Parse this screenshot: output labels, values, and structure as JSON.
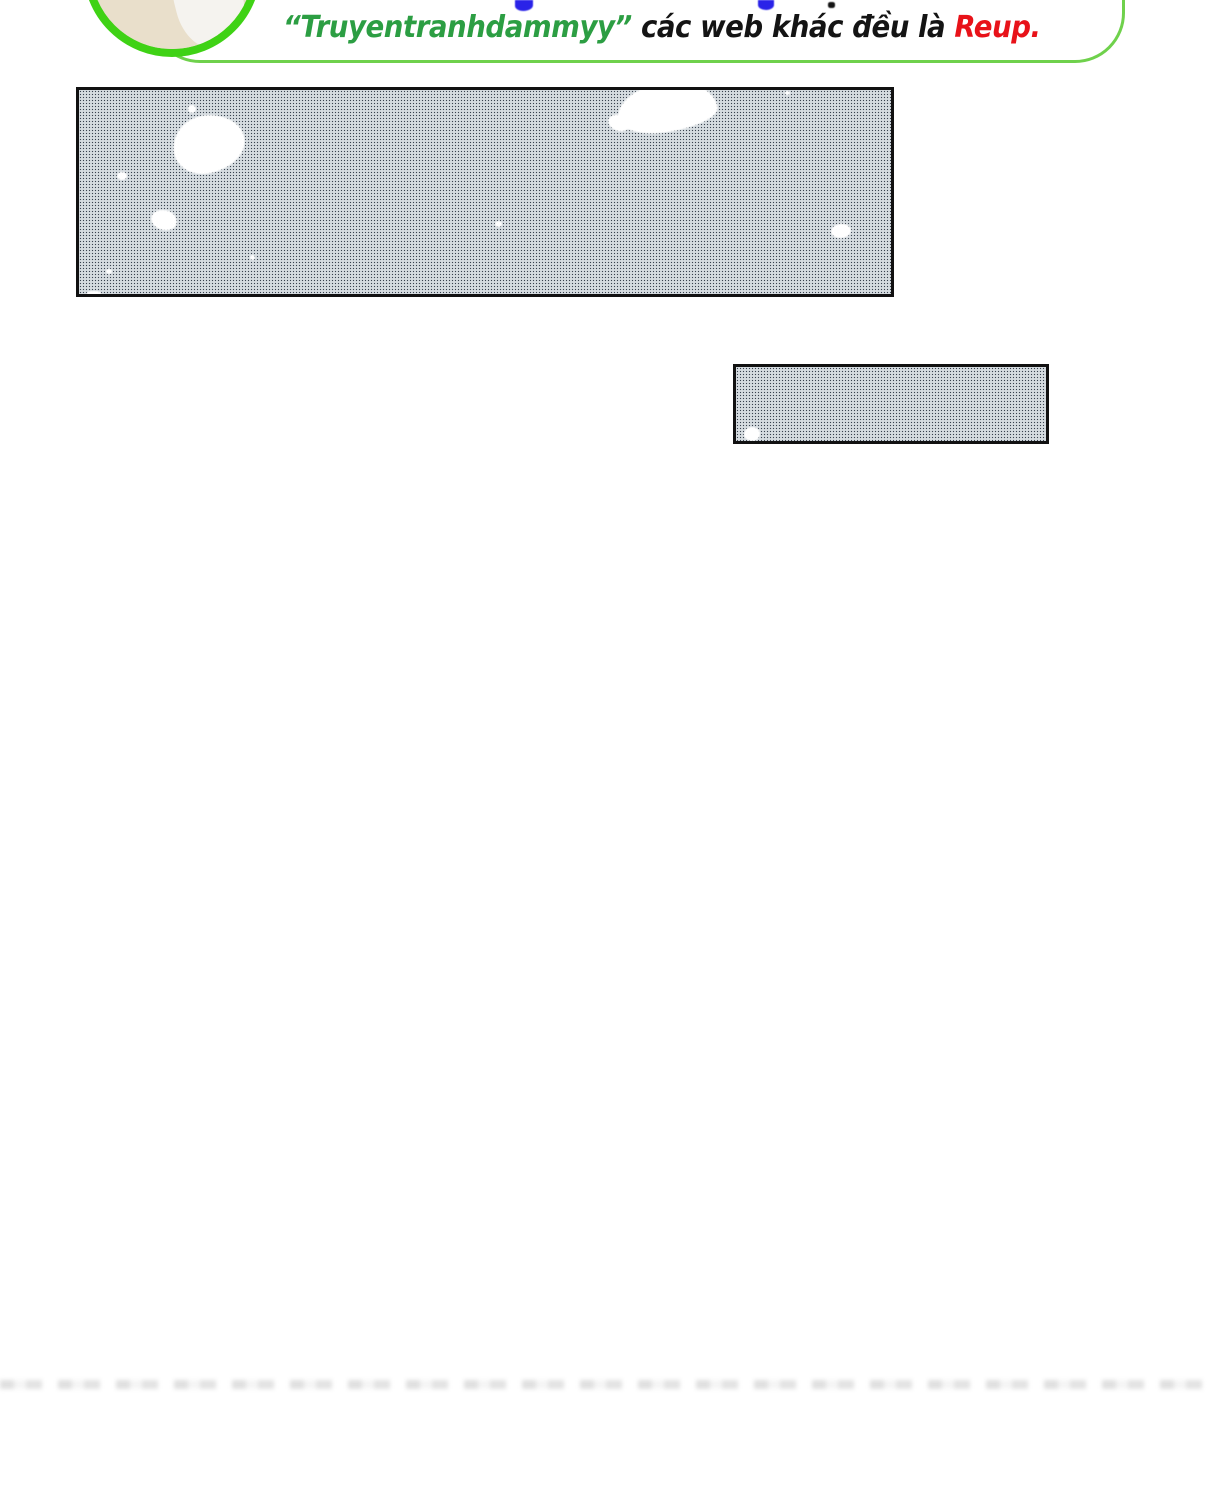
{
  "page": {
    "width": 1207,
    "height": 1500,
    "background": "#ffffff"
  },
  "banner": {
    "type": "translator-credit-banner",
    "message": {
      "quoted": "“Truyentranhdammyy”",
      "middle": " các web khác đều là ",
      "emphasis": "Reup."
    },
    "cutoff_top_line_fragments": [
      {
        "x": 515,
        "y": 0,
        "w": 18,
        "h": 11,
        "color": "#2a23e8",
        "radius": "0 0 70% 60%"
      },
      {
        "x": 758,
        "y": 0,
        "w": 16,
        "h": 10,
        "color": "#2a23e8",
        "radius": "0 0 55% 55%"
      },
      {
        "x": 828,
        "y": 2,
        "w": 7,
        "h": 6,
        "color": "#141414",
        "radius": "35%"
      }
    ],
    "colors": {
      "border_green": "#6fd14c",
      "avatar_ring_green": "#3fd215",
      "quoted_green": "#2c9e43",
      "text_black": "#141414",
      "emphasis_red": "#e81219",
      "fragment_blue": "#2a23e8"
    }
  },
  "screentone": {
    "dark": "#39424e",
    "light": "#f2f5f7",
    "base": "#ccd3d8",
    "panel_border": "#111111",
    "spot_color": "#ffffff"
  },
  "panels": [
    {
      "name": "screentone-panel-large",
      "x": 76,
      "y": 87,
      "w": 818,
      "h": 210,
      "blobs": [
        {
          "cx": 130,
          "cy": 54,
          "rx": 36,
          "ry": 29,
          "radius": "46% 54% 58% 42% / 55% 50% 50% 45%",
          "rot": -10
        },
        {
          "cx": 113,
          "cy": 19,
          "rx": 4,
          "ry": 4
        },
        {
          "cx": 43,
          "cy": 86,
          "rx": 5,
          "ry": 4
        },
        {
          "cx": 85,
          "cy": 130,
          "rx": 13,
          "ry": 10,
          "radius": "55% 45% 50% 50% / 50% 55% 45% 50%",
          "rot": 15
        },
        {
          "cx": 173,
          "cy": 167,
          "rx": 2.5,
          "ry": 2.5
        },
        {
          "cx": 30,
          "cy": 181,
          "rx": 3,
          "ry": 2.5
        },
        {
          "cx": 15,
          "cy": 203,
          "rx": 7,
          "ry": 2.5,
          "radius": "40%"
        },
        {
          "cx": 588,
          "cy": 17,
          "rx": 50,
          "ry": 25,
          "radius": "52% 48% 55% 45% / 60% 65% 35% 40%",
          "rot": -8
        },
        {
          "cx": 540,
          "cy": 33,
          "rx": 11,
          "ry": 8,
          "rot": 20
        },
        {
          "cx": 708,
          "cy": 3,
          "rx": 2.5,
          "ry": 2
        },
        {
          "cx": 419,
          "cy": 134,
          "rx": 3.5,
          "ry": 3
        },
        {
          "cx": 762,
          "cy": 141,
          "rx": 10,
          "ry": 7,
          "rot": -5
        }
      ]
    },
    {
      "name": "screentone-panel-small",
      "x": 733,
      "y": 364,
      "w": 316,
      "h": 80,
      "blobs": [
        {
          "cx": 16,
          "cy": 67,
          "rx": 8,
          "ry": 7,
          "radius": "50% 50% 45% 55% / 55% 45% 55% 45%"
        }
      ]
    }
  ],
  "bottom_artifact": {
    "y": 1380,
    "h": 9
  }
}
